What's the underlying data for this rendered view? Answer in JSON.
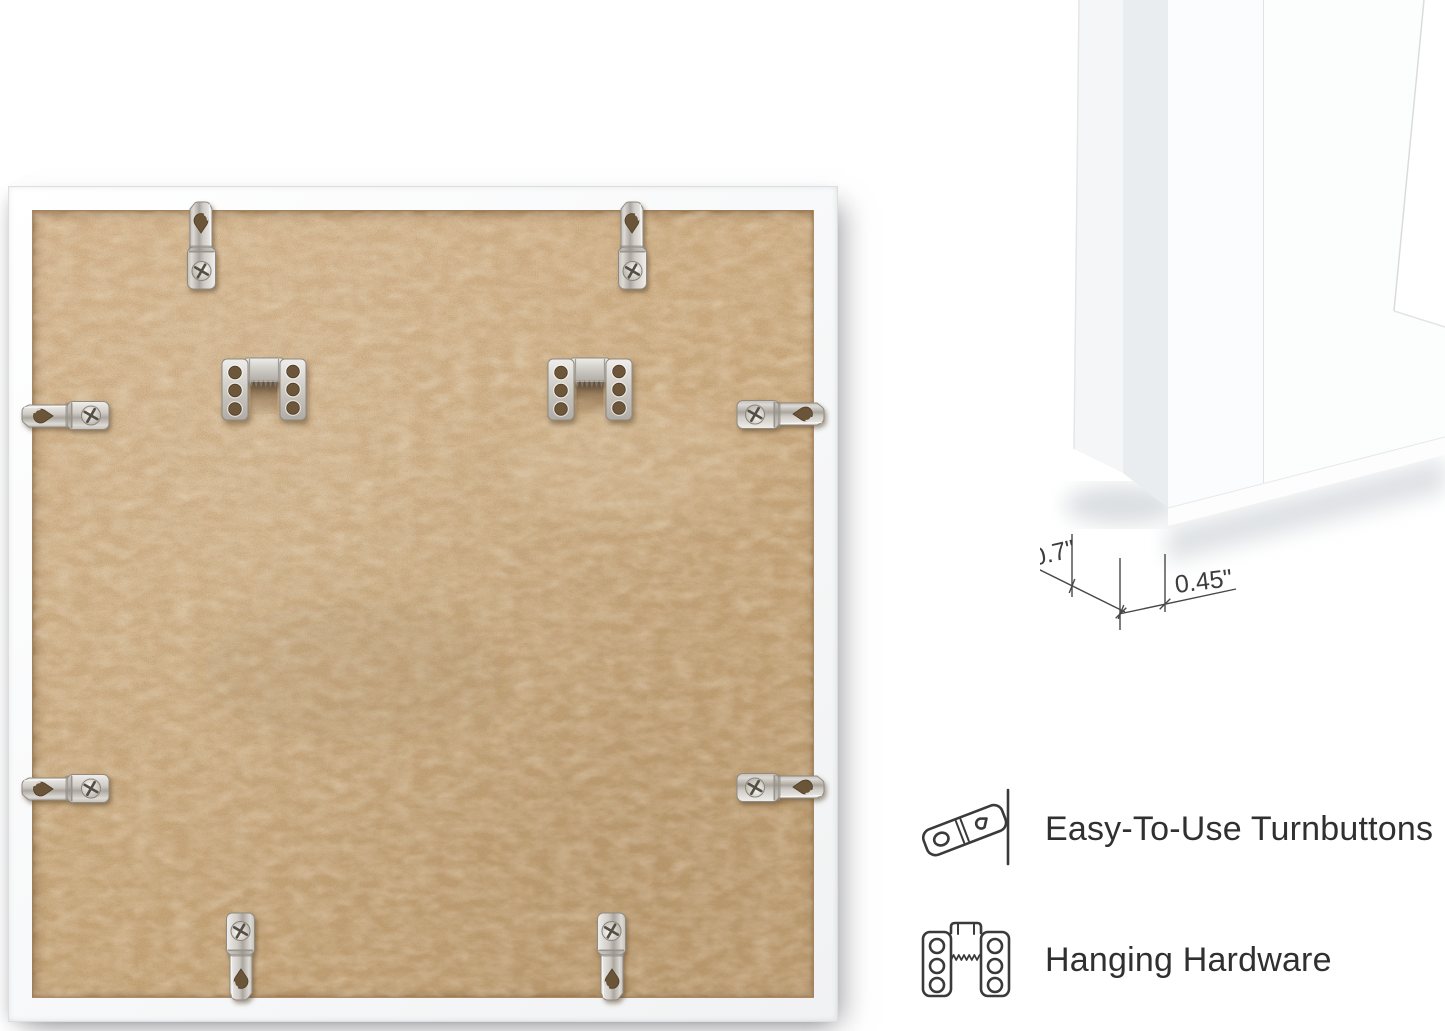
{
  "scene": {
    "background": "#ffffff",
    "description": "product photo: back of white square picture frame with mounting hardware, corner depth diagram and feature callouts"
  },
  "back_view": {
    "frame_color": "#fbfbfb",
    "backing_color": "#cdab80",
    "metal_color": "#d6d3cf",
    "turnbutton_count": 8,
    "sawtooth_hanger_count": 2
  },
  "corner_detail": {
    "depth_label": "0.7\"",
    "face_label": "0.45\""
  },
  "features": {
    "items": [
      {
        "icon": "turnbutton-icon",
        "label": "Easy-To-Use Turnbuttons"
      },
      {
        "icon": "hanging-hardware-icon",
        "label": "Hanging Hardware"
      }
    ]
  }
}
